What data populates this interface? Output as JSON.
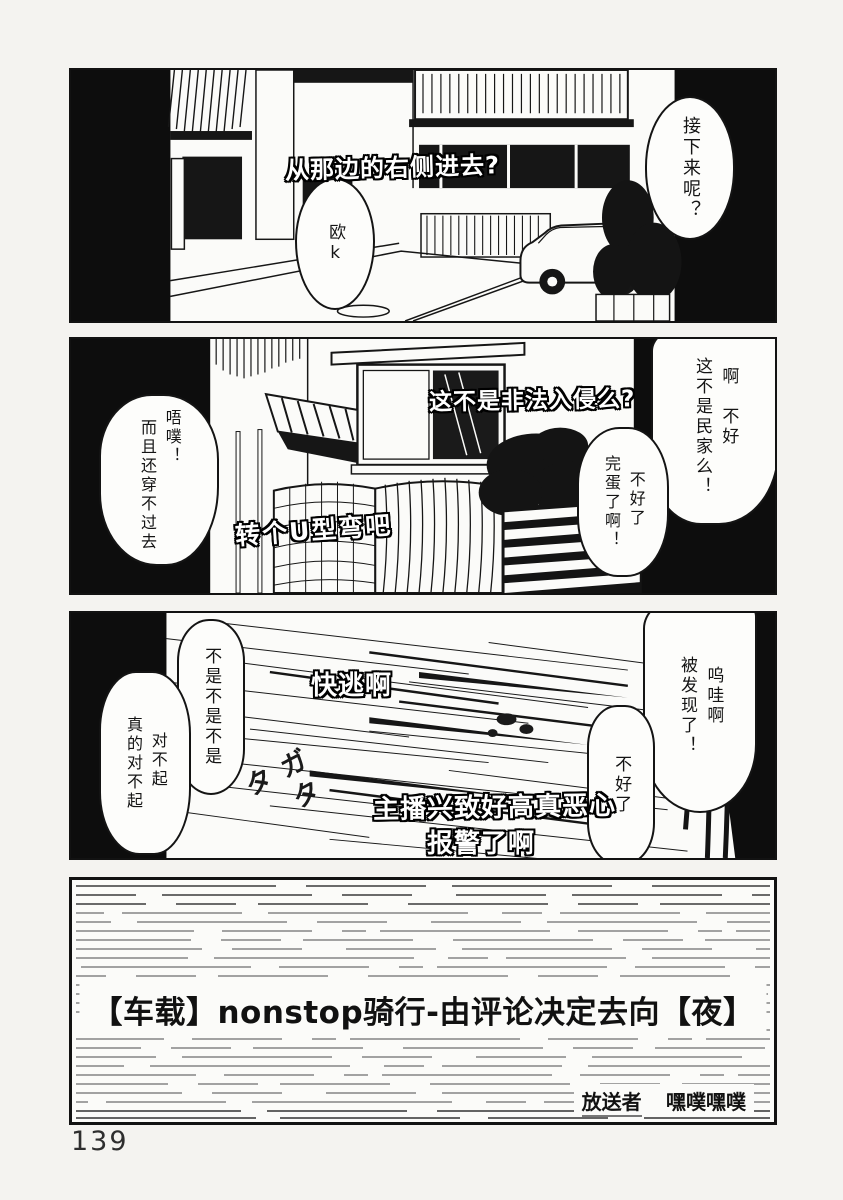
{
  "colors": {
    "ink": "#141414",
    "paper": "#fbfbf9"
  },
  "page": {
    "number": "139"
  },
  "panel1": {
    "caption": "从那边的右侧进去?",
    "bubble_ok": "欧k",
    "bubble_next": "接下来呢？"
  },
  "panel2": {
    "caption_top": "这不是非法入侵么?",
    "caption_u_turn": "转个U型弯吧",
    "bubble_left": [
      "唔噗！",
      "而且还穿不过去"
    ],
    "bubble_right_top": [
      "啊　不好",
      "这不是民家么！"
    ],
    "bubble_right_mid": [
      "不好了",
      "完蛋了啊！"
    ]
  },
  "panel3": {
    "caption_run": "快逃啊",
    "caption_streamer": "主播兴致好高真恶心",
    "caption_report": "报警了啊",
    "sfx": "ガタタ",
    "bubble_deny": "不是不是不是",
    "bubble_sorry": [
      "对不起",
      "真的对不起"
    ],
    "bubble_spotted": [
      "呜哇啊",
      "被发现了！"
    ],
    "bubble_uh_oh": "不好了"
  },
  "panel4": {
    "title": "【车载】nonstop骑行-由评论决定去向【夜】",
    "broadcaster_label": "放送者",
    "broadcaster_name": "嘿噗嘿噗"
  }
}
